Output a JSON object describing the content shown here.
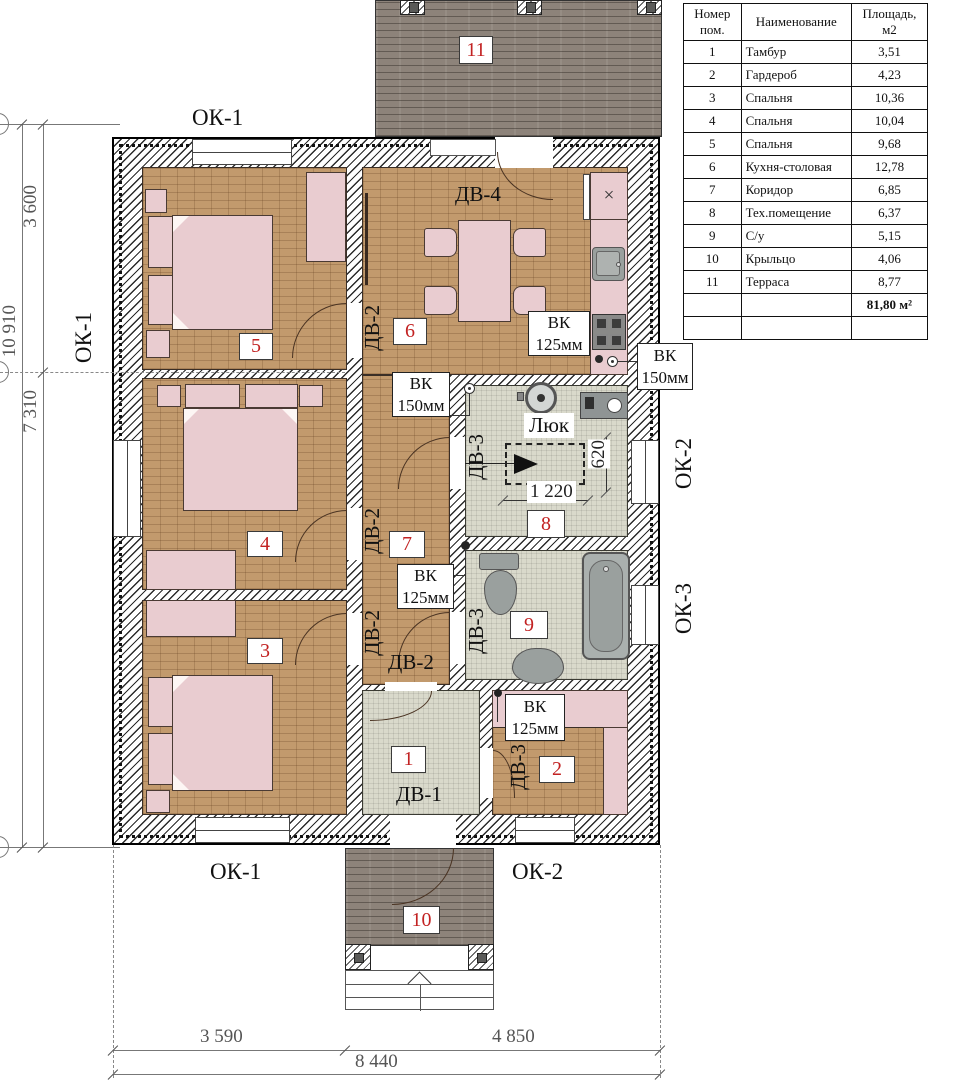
{
  "plan": {
    "room_numbers": {
      "r1": "1",
      "r2": "2",
      "r3": "3",
      "r4": "4",
      "r5": "5",
      "r6": "6",
      "r7": "7",
      "r8": "8",
      "r9": "9",
      "r10": "10",
      "r11": "11"
    },
    "window_labels": {
      "ok1": "ОК-1",
      "ok2": "ОК-2",
      "ok3": "ОК-3"
    },
    "door_labels": {
      "dv1": "ДВ-1",
      "dv2": "ДВ-2",
      "dv3": "ДВ-3",
      "dv4": "ДВ-4"
    },
    "vent": {
      "vk": "ВК",
      "d125": "125мм",
      "d150": "150мм"
    },
    "hatch_label": "Люк",
    "dims": {
      "left_3600": "3 600",
      "left_10910": "10 910",
      "left_7310": "7 310",
      "bottom_3590": "3 590",
      "bottom_4850": "4 850",
      "bottom_8440": "8 440",
      "hatch_w": "1 220",
      "hatch_h": "620"
    },
    "colors": {
      "accent_red": "#c22222",
      "wood": "#c29a6d",
      "tile": "#d9d9cb",
      "brick": "#8d837a",
      "furniture": "#e9ccd0"
    }
  },
  "legend_table": {
    "headers": [
      "Номер пом.",
      "Наименование",
      "Площадь, м2"
    ],
    "rows": [
      {
        "num": "1",
        "name": "Тамбур",
        "area": "3,51"
      },
      {
        "num": "2",
        "name": "Гардероб",
        "area": "4,23"
      },
      {
        "num": "3",
        "name": "Спальня",
        "area": "10,36"
      },
      {
        "num": "4",
        "name": "Спальня",
        "area": "10,04"
      },
      {
        "num": "5",
        "name": "Спальня",
        "area": "9,68"
      },
      {
        "num": "6",
        "name": "Кухня-столовая",
        "area": "12,78"
      },
      {
        "num": "7",
        "name": "Коридор",
        "area": "6,85"
      },
      {
        "num": "8",
        "name": "Тех.помещение",
        "area": "6,37"
      },
      {
        "num": "9",
        "name": "С/у",
        "area": "5,15"
      },
      {
        "num": "10",
        "name": "Крыльцо",
        "area": "4,06"
      },
      {
        "num": "11",
        "name": "Терраса",
        "area": "8,77"
      }
    ],
    "total": "81,80 м²"
  }
}
